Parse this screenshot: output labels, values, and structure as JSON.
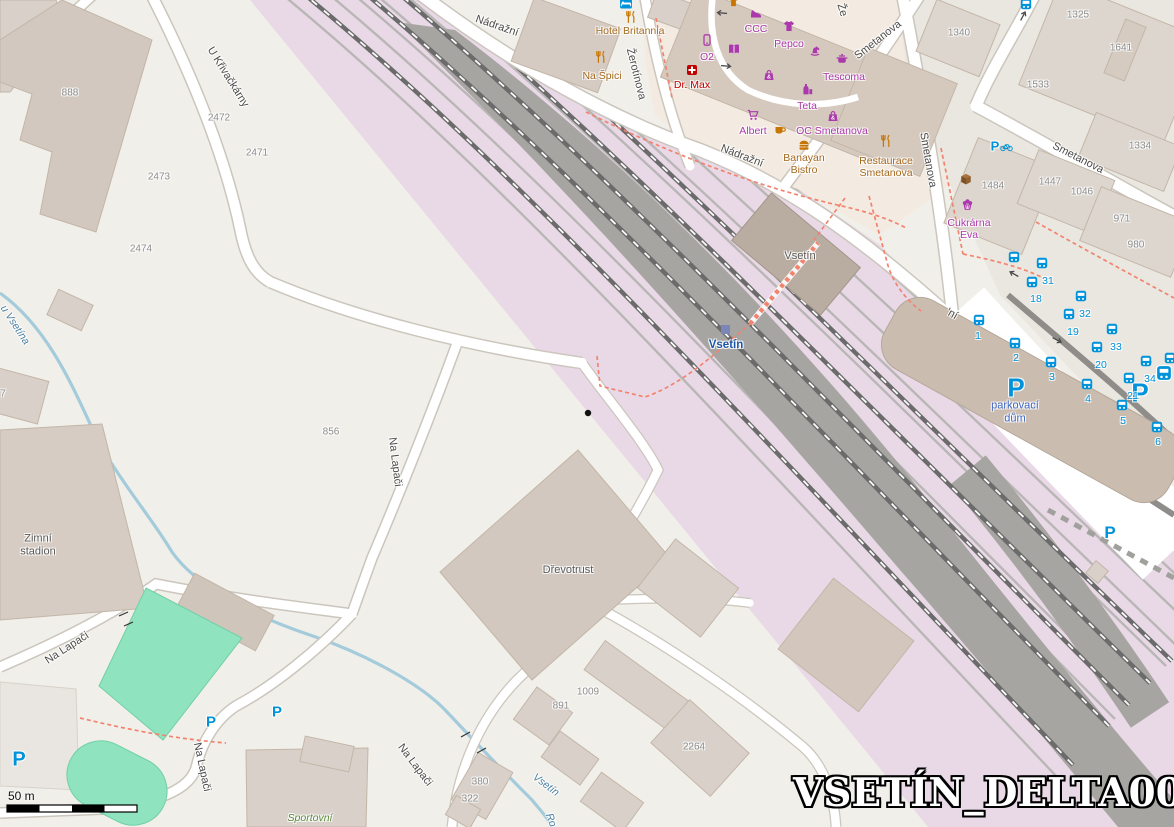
{
  "watermark": "VSETÍN_DELTA001",
  "scale": {
    "label": "50 m"
  },
  "streets": {
    "nadrazni_a": "Nádražní",
    "nadrazni_b": "Nádražní",
    "nadrazni_frag": "'ní",
    "zerotinova": "Žerotínova",
    "zerotinova_frag": "Že",
    "smetanova_diag": "Smetanova",
    "smetanova_vert": "Smetanova",
    "smetanova_east": "Smetanova",
    "u_krivackarny": "U Křivačkárny",
    "na_lapaci_mid": "Na Lapači",
    "na_lapaci_sw": "Na Lapači",
    "na_lapaci_s": "Na Lapači",
    "na_lapaci_se": "Na Lapači"
  },
  "waters": {
    "u_vsetina": "u Vsetína",
    "vsetin": "Vsetín",
    "ro_frag": "Ro"
  },
  "places": {
    "zimni_stadion": "Zimní stadion",
    "drevotrust": "Dřevotrust",
    "sportovni": "Sportovní"
  },
  "station": {
    "stop": "Vsetín",
    "building": "Vsetín"
  },
  "parking": {
    "p": "P",
    "house": "parkovací dům"
  },
  "pois": {
    "hotel_britannia": "Hotel Britannia",
    "hotel_number": "805",
    "na_spici": "Na Špici",
    "ccc": "CCC",
    "pepco": "Pepco",
    "o2": "O2",
    "dr_max": "Dr. Max",
    "teta": "Teta",
    "albert": "Albert",
    "oc_smetanova": "OC Smetanova",
    "tescoma": "Tescoma",
    "banayan": "Banayan Bistro",
    "restaurace_smetanova": "Restaurace Smetanova",
    "cukrarna_eva": "Cukrárna Eva"
  },
  "housenumbers": {
    "888": "888",
    "2472": "2472",
    "2471": "2471",
    "2473": "2473",
    "2474": "2474",
    "856": "856",
    "7": "7",
    "1340": "1340",
    "1325": "1325",
    "1641": "1641",
    "1533": "1533",
    "1334": "1334",
    "1484": "1484",
    "1447": "1447",
    "1046": "1046",
    "971": "971",
    "980": "980",
    "1009": "1009",
    "891": "891",
    "2264": "2264",
    "380": "380",
    "322": "322"
  },
  "bus": {
    "platforms": [
      "1",
      "2",
      "3",
      "4",
      "5",
      "6",
      "18",
      "19",
      "20",
      "21",
      "31",
      "32",
      "33",
      "34"
    ]
  },
  "colors": {
    "railway_area": "#e9d9e6",
    "platform_gray": "#a7a5a1",
    "water": "#a3cbdb",
    "pitch_green": "#8fe3bf",
    "building": "#d9d0c9",
    "path_red_dashed": "#f2836f",
    "transport_blue": "#0092da",
    "shop_magenta": "#ac39ac",
    "food_orange": "#a5691e",
    "pharmacy_red": "#bf0000",
    "station_label_blue": "#1a56a8",
    "water_label_blue": "#4a80a5"
  },
  "icons": {
    "bus-icon": "#0092da",
    "bus-station-icon": "#0092da",
    "parking-icon": "#0092da",
    "bicycle-parking-icon": "#0092da",
    "hotel-bed-icon": "#0092da",
    "restaurant-fork-knife-icon": "#C77400",
    "fast-food-burger-icon": "#C77400",
    "cafe-cup-icon": "#C77400",
    "supermarket-cart-icon": "#ac39ac",
    "shoe-shop-icon": "#ac39ac",
    "clothes-shop-icon": "#ac39ac",
    "toy-shop-icon": "#ac39ac",
    "mobile-phone-shop-icon": "#ac39ac",
    "book-shop-icon": "#ac39ac",
    "pharmacy-cross-icon": "#bf0000",
    "chemist-shop-icon": "#ac39ac",
    "houseware-pot-icon": "#ac39ac",
    "mall-bag-icon": "#ac39ac",
    "confectionery-cupcake-icon": "#ac39ac",
    "parcel-locker-icon": "#8a6642",
    "railway-station-icon": "#7b85b8",
    "oneway-arrow-icon": "#4a4a4a",
    "poi-dot-icon": "#111111"
  }
}
